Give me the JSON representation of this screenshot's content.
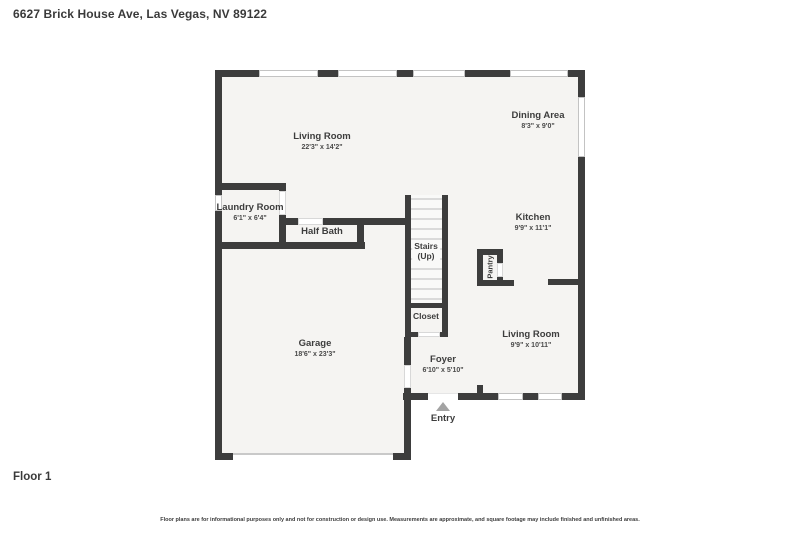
{
  "header": {
    "title": "6627 Brick House Ave, Las Vegas, NV 89122"
  },
  "floor_label": "Floor 1",
  "footer": {
    "disclaimer": "Floor plans are for informational purposes only and not for construction or design use. Measurements are approximate, and square footage may include finished and unfinished areas."
  },
  "colors": {
    "wall": "#3d3d3d",
    "floor": "#f5f4f2",
    "window_border": "#c3c3c3",
    "stair_tread": "#dadada",
    "entry_arrow": "#a3a3a3",
    "text": "#3d3d3d"
  },
  "rooms": {
    "living_main": {
      "name": "Living Room",
      "dims": "22'3\" x 14'2\""
    },
    "dining": {
      "name": "Dining Area",
      "dims": "8'3\" x 9'0\""
    },
    "laundry": {
      "name": "Laundry Room",
      "dims": "6'1\" x 6'4\""
    },
    "half_bath": {
      "name": "Half Bath"
    },
    "stairs": {
      "name": "Stairs",
      "sub": "(Up)"
    },
    "kitchen": {
      "name": "Kitchen",
      "dims": "9'9\" x 11'1\""
    },
    "pantry": {
      "name": "Pantry"
    },
    "closet": {
      "name": "Closet"
    },
    "living_lower": {
      "name": "Living Room",
      "dims": "9'9\" x 10'11\""
    },
    "garage": {
      "name": "Garage",
      "dims": "18'6\" x 23'3\""
    },
    "foyer": {
      "name": "Foyer",
      "dims": "6'10\" x 5'10\""
    },
    "entry": {
      "name": "Entry"
    }
  }
}
